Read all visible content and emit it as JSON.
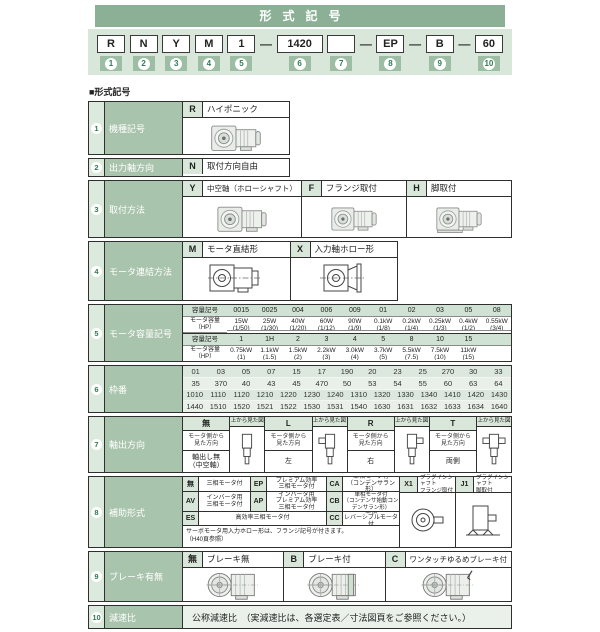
{
  "section_label": "■形式記号",
  "header": {
    "title": "形式記号",
    "dash": "—",
    "boxes": [
      {
        "code": "R",
        "num": "1"
      },
      {
        "code": "N",
        "num": "2"
      },
      {
        "code": "Y",
        "num": "3"
      },
      {
        "code": "M",
        "num": "4"
      },
      {
        "code": "1",
        "num": "5"
      },
      {
        "code": "1420",
        "num": "6"
      },
      {
        "code": "",
        "num": "7"
      },
      {
        "code": "EP",
        "num": "8"
      },
      {
        "code": "B",
        "num": "9"
      },
      {
        "code": "60",
        "num": "10"
      }
    ]
  },
  "rows": {
    "r1": {
      "num": "1",
      "label": "機種記号",
      "code": "R",
      "desc": "ハイポニック"
    },
    "r2": {
      "num": "2",
      "label": "出力軸方向",
      "code": "N",
      "desc": "取付方向自由"
    },
    "r3": {
      "num": "3",
      "label": "取付方法",
      "opts": [
        {
          "code": "Y",
          "desc": "中空軸（ホローシャフト）"
        },
        {
          "code": "F",
          "desc": "フランジ取付"
        },
        {
          "code": "H",
          "desc": "脚取付"
        }
      ]
    },
    "r4": {
      "num": "4",
      "label": "モータ連結方法",
      "opts": [
        {
          "code": "M",
          "desc": "モータ直結形"
        },
        {
          "code": "X",
          "desc": "入力軸ホロー形"
        }
      ]
    },
    "r5": {
      "num": "5",
      "label": "モータ容量記号",
      "tableA": {
        "code_label": "容量記号",
        "cap_label": "モータ容量\n（HP）",
        "codes": [
          "0015",
          "0025",
          "004",
          "006",
          "009",
          "01",
          "02",
          "03",
          "05",
          "08"
        ],
        "caps": [
          {
            "v": "15W",
            "hp": "(1/50)"
          },
          {
            "v": "25W",
            "hp": "(1/30)"
          },
          {
            "v": "40W",
            "hp": "(1/20)"
          },
          {
            "v": "60W",
            "hp": "(1/12)"
          },
          {
            "v": "90W",
            "hp": "(1/9)"
          },
          {
            "v": "0.1kW",
            "hp": "(1/8)"
          },
          {
            "v": "0.2kW",
            "hp": "(1/4)"
          },
          {
            "v": "0.25kW",
            "hp": "(1/3)"
          },
          {
            "v": "0.4kW",
            "hp": "(1/2)"
          },
          {
            "v": "0.55kW",
            "hp": "(3/4)"
          }
        ]
      },
      "tableB": {
        "code_label": "容量記号",
        "cap_label": "モータ容量\n（HP）",
        "codes": [
          "1",
          "1H",
          "2",
          "3",
          "4",
          "5",
          "8",
          "10",
          "15",
          ""
        ],
        "caps": [
          {
            "v": "0.75kW",
            "hp": "(1)"
          },
          {
            "v": "1.1kW",
            "hp": "(1.5)"
          },
          {
            "v": "1.5kW",
            "hp": "(2)"
          },
          {
            "v": "2.2kW",
            "hp": "(3)"
          },
          {
            "v": "3.0kW",
            "hp": "(4)"
          },
          {
            "v": "3.7kW",
            "hp": "(5)"
          },
          {
            "v": "5.5kW",
            "hp": "(7.5)"
          },
          {
            "v": "7.5kW",
            "hp": "(10)"
          },
          {
            "v": "11kW",
            "hp": "(15)"
          },
          {
            "v": "",
            "hp": ""
          }
        ]
      }
    },
    "r6": {
      "num": "6",
      "label": "枠番",
      "lines": [
        [
          "01",
          "03",
          "05",
          "07",
          "15",
          "17",
          "190",
          "20",
          "23",
          "25",
          "270",
          "30",
          "33"
        ],
        [
          "35",
          "370",
          "40",
          "43",
          "45",
          "470",
          "50",
          "53",
          "54",
          "55",
          "60",
          "63",
          "64"
        ],
        [
          "1010",
          "1110",
          "1120",
          "1210",
          "1220",
          "1230",
          "1240",
          "1310",
          "1320",
          "1330",
          "1340",
          "1410",
          "1420",
          "1430"
        ],
        [
          "1440",
          "1510",
          "1520",
          "1521",
          "1522",
          "1530",
          "1531",
          "1540",
          "1630",
          "1631",
          "1632",
          "1633",
          "1634",
          "1640"
        ]
      ]
    },
    "r7": {
      "num": "7",
      "label": "軸出方向",
      "view_caption": "上から見た図",
      "side_label": "モータ側から\n見た方向",
      "dirs": [
        {
          "code": "無",
          "value": "軸出し無\n（中空軸）"
        },
        {
          "code": "L",
          "value": "左"
        },
        {
          "code": "R",
          "value": "右"
        },
        {
          "code": "T",
          "value": "両側"
        }
      ]
    },
    "r8": {
      "num": "8",
      "label": "補助形式",
      "c1": {
        "code": "無",
        "desc": "三相モータ付"
      },
      "c2": {
        "code": "EP",
        "desc": "プレミアム効率\n三相モータ付"
      },
      "c3": {
        "code": "CA",
        "desc": "単相モータ付\n（コンデンサラン形）"
      },
      "c4": {
        "code": "AV",
        "desc": "インバータ用\n三相モータ付"
      },
      "c5": {
        "code": "AP",
        "desc": "インバータ用\nプレミアム効率\n三相モータ付"
      },
      "c6": {
        "code": "CB",
        "desc": "単相モータ付\n（コンデンサ始動コンデンサラン形）"
      },
      "c7": {
        "code": "ES",
        "desc": "高効率三相モータ付"
      },
      "c8": {
        "code": "CC",
        "desc": "単相\nレバーシブルモータ付"
      },
      "x1": {
        "code": "X1",
        "desc": "プラグインシャフト\nフランジ取付"
      },
      "j1": {
        "code": "J1",
        "desc": "プラグインシャフト\n脚取付"
      },
      "note": "サーボモータ用入力ホロー形は、フランジ記号が付きます。\n（H40頁参照）"
    },
    "r9": {
      "num": "9",
      "label": "ブレーキ有無",
      "opts": [
        {
          "code": "無",
          "desc": "ブレーキ無"
        },
        {
          "code": "B",
          "desc": "ブレーキ付"
        },
        {
          "code": "C",
          "desc": "ワンタッチゆるめブレーキ付"
        }
      ]
    },
    "r10": {
      "num": "10",
      "label": "減速比",
      "desc": "公称減速比　（実減速比は、各選定表／寸法図頁をご参照ください。）"
    }
  }
}
